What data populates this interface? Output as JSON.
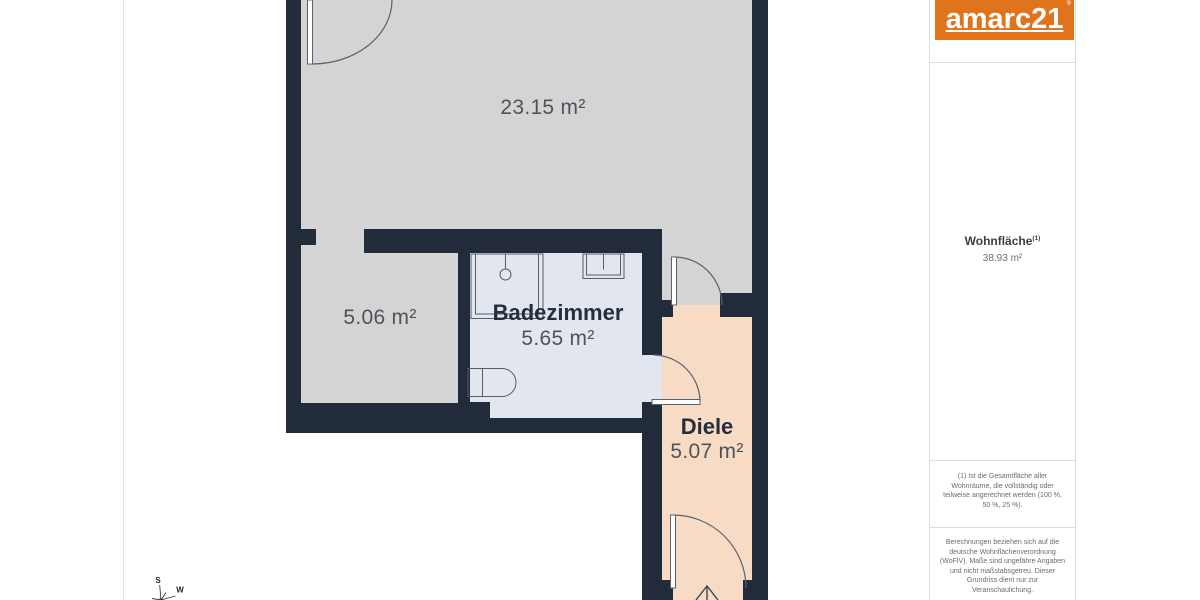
{
  "floor_plan": {
    "rooms": {
      "living": {
        "area": "23.15 m²"
      },
      "side_room": {
        "area": "5.06 m²"
      },
      "bathroom": {
        "name": "Badezimmer",
        "area": "5.65 m²"
      },
      "hallway": {
        "name": "Diele",
        "area": "5.07 m²"
      }
    },
    "compass": {
      "south": "S",
      "west": "W"
    },
    "colors": {
      "wall": "#212b3a",
      "floor_gray": "#d4d4d4",
      "floor_bath": "#e2e7ef",
      "floor_hall": "#f7dbc5"
    }
  },
  "sidebar": {
    "logo": {
      "text": "amarc21",
      "mark": "®",
      "color": "#e0741d"
    },
    "area_summary": {
      "label": "Wohnfläche",
      "footnote_ref": "(1)",
      "value": "38.93 m²"
    },
    "footnote": {
      "lines": [
        "(1) Ist die Gesamtfläche aller",
        "Wohnräume, die vollständig oder",
        "teilweise angerechnet werden (100 %,",
        "50 %, 25 %)."
      ]
    },
    "disclaimer": {
      "lines": [
        "Berechnungen beziehen sich auf die",
        "deutsche Wohnflächenverordnung",
        "(WoFlV). Maße sind ungefähre Angaben",
        "und nicht maßstabsgetreu. Dieser",
        "Grundriss dient nur zur",
        "Veranschaulichung."
      ]
    }
  }
}
